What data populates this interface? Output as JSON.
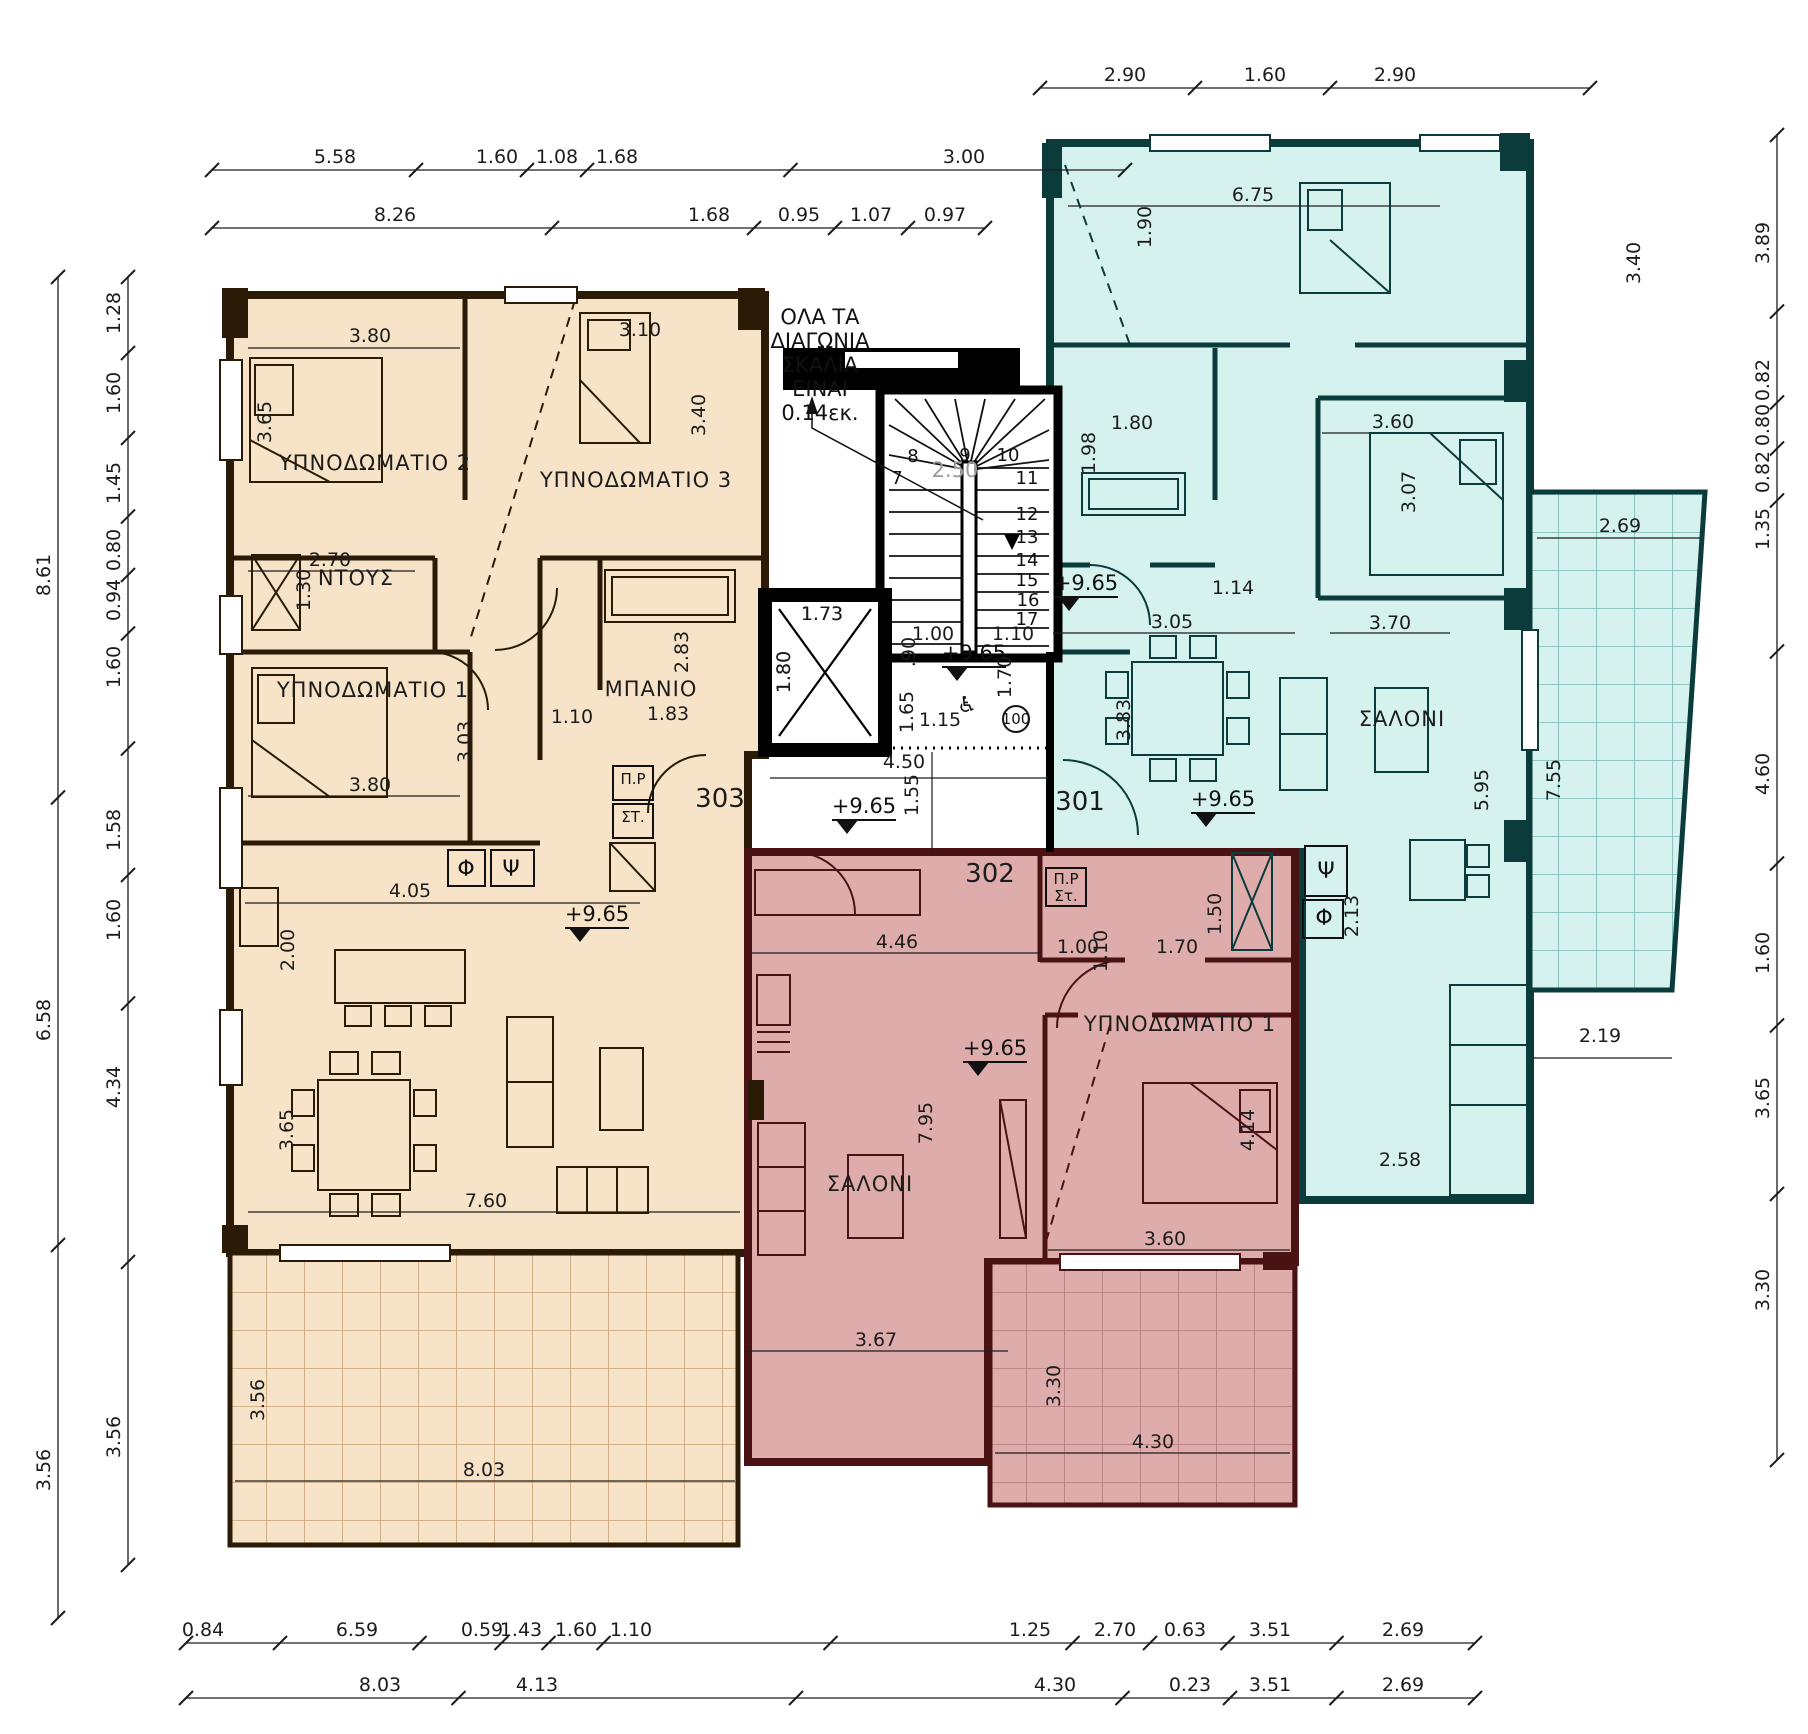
{
  "drawing": {
    "type": "architectural-floor-plan",
    "level_value": "+9.65",
    "units": [
      {
        "id": "301",
        "x": 1080,
        "y": 810,
        "fill": "#d6f2ef",
        "wall": "#0c3b3c"
      },
      {
        "id": "302",
        "x": 990,
        "y": 882,
        "fill": "#dfacac",
        "wall": "#4a1212"
      },
      {
        "id": "303",
        "x": 720,
        "y": 807,
        "fill": "#f6e3c8",
        "wall": "#2b1a06"
      }
    ]
  },
  "note": {
    "lines": [
      "ΟΛΑ ΤΑ",
      "ΔΙΑΓΩΝΙΑ",
      "ΣΚΑΛΙΑ",
      "ΕΙΝΑΙ",
      "0.14εκ."
    ],
    "x": 820,
    "y0": 324,
    "dy": 24
  },
  "stair": {
    "width_label": "2.50",
    "width_x": 955,
    "width_y": 477,
    "numbers": [
      [
        "7",
        897,
        484
      ],
      [
        "8",
        913,
        462
      ],
      [
        "9",
        965,
        461
      ],
      [
        "10",
        1008,
        461
      ],
      [
        "11",
        1027,
        484
      ],
      [
        "12",
        1027,
        520
      ],
      [
        "13",
        1027,
        543
      ],
      [
        "14",
        1027,
        566
      ],
      [
        "15",
        1027,
        586
      ],
      [
        "16",
        1028,
        606
      ],
      [
        "17",
        1027,
        625
      ]
    ]
  },
  "elevator": {
    "width": "1.80",
    "depth": "1.73"
  },
  "levels": [
    {
      "x": 974,
      "y": 660
    },
    {
      "x": 864,
      "y": 813
    },
    {
      "x": 1086,
      "y": 590
    },
    {
      "x": 1223,
      "y": 806
    },
    {
      "x": 597,
      "y": 921
    },
    {
      "x": 995,
      "y": 1055
    }
  ],
  "room_labels": [
    {
      "t": "ΥΠΝΟΔΩΜΑΤΙΟ 2",
      "x": 375,
      "y": 470
    },
    {
      "t": "ΥΠΝΟΔΩΜΑΤΙΟ 3",
      "x": 636,
      "y": 487
    },
    {
      "t": "ΝΤΟΥΣ",
      "x": 356,
      "y": 585
    },
    {
      "t": "ΥΠΝΟΔΩΜΑΤΙΟ 1",
      "x": 373,
      "y": 697
    },
    {
      "t": "ΜΠΑΝΙΟ",
      "x": 651,
      "y": 696
    },
    {
      "t": "ΣΑΛΟΝΙ",
      "x": 1402,
      "y": 726
    },
    {
      "t": "ΣΑΛΟΝΙ",
      "x": 870,
      "y": 1191
    },
    {
      "t": "ΥΠΝΟΔΩΜΑΤΙΟ 1",
      "x": 1180,
      "y": 1031
    }
  ],
  "symbols": [
    {
      "t": "Φ",
      "x": 466,
      "y": 876,
      "bx": 448,
      "by": 850,
      "bw": 37,
      "bh": 36,
      "big": true
    },
    {
      "t": "Ψ",
      "x": 511,
      "y": 876,
      "bx": 491,
      "by": 850,
      "bw": 43,
      "bh": 36,
      "big": true
    },
    {
      "t": "Π.Ρ",
      "x": 633,
      "y": 784,
      "bx": 613,
      "by": 766,
      "bw": 40,
      "bh": 34,
      "big": false
    },
    {
      "t": "ΣΤ.",
      "x": 633,
      "y": 822,
      "bx": 613,
      "by": 804,
      "bw": 40,
      "bh": 34,
      "big": false
    },
    {
      "t": "Π.Ρ",
      "x": 1066,
      "y": 884,
      "bx": 1046,
      "by": 868,
      "bw": 40,
      "bh": 38,
      "big": false
    },
    {
      "t": "Στ.",
      "x": 1066,
      "y": 901,
      "bx": 0,
      "by": 0,
      "bw": 0,
      "bh": 0,
      "big": false
    },
    {
      "t": "Ψ",
      "x": 1326,
      "y": 878,
      "bx": 1305,
      "by": 846,
      "bw": 42,
      "bh": 50,
      "big": true
    },
    {
      "t": "Φ",
      "x": 1324,
      "y": 925,
      "bx": 1303,
      "by": 900,
      "bw": 40,
      "bh": 38,
      "big": true
    }
  ],
  "access_circle": {
    "t": "100",
    "x": 1016,
    "y": 719,
    "r": 13
  },
  "whe": {
    "t": "♿",
    "x": 967,
    "y": 712
  },
  "free_dims": [
    {
      "v": "3.80",
      "x": 370,
      "y": 342,
      "r": 0
    },
    {
      "v": "3.65",
      "x": 271,
      "y": 422,
      "r": 1
    },
    {
      "v": "3.10",
      "x": 640,
      "y": 336,
      "r": 0
    },
    {
      "v": "3.40",
      "x": 705,
      "y": 415,
      "r": 1
    },
    {
      "v": "2.70",
      "x": 330,
      "y": 566,
      "r": 0
    },
    {
      "v": "1.30",
      "x": 310,
      "y": 590,
      "r": 1
    },
    {
      "v": "3.03",
      "x": 471,
      "y": 742,
      "r": 1
    },
    {
      "v": "3.80",
      "x": 370,
      "y": 791,
      "r": 0
    },
    {
      "v": "1.10",
      "x": 572,
      "y": 723,
      "r": 0
    },
    {
      "v": "2.83",
      "x": 688,
      "y": 652,
      "r": 1
    },
    {
      "v": "1.83",
      "x": 668,
      "y": 720,
      "r": 0
    },
    {
      "v": "4.05",
      "x": 410,
      "y": 897,
      "r": 0
    },
    {
      "v": "2.00",
      "x": 294,
      "y": 950,
      "r": 1
    },
    {
      "v": "3.65",
      "x": 293,
      "y": 1130,
      "r": 1
    },
    {
      "v": "7.60",
      "x": 486,
      "y": 1207,
      "r": 0
    },
    {
      "v": "8.03",
      "x": 484,
      "y": 1476,
      "r": 0
    },
    {
      "v": "3.56",
      "x": 264,
      "y": 1400,
      "r": 1
    },
    {
      "v": "1.80",
      "x": 790,
      "y": 672,
      "r": 1
    },
    {
      "v": "1.73",
      "x": 822,
      "y": 620,
      "r": 0
    },
    {
      "v": "1.00",
      "x": 933,
      "y": 640,
      "r": 0
    },
    {
      "v": "1.10",
      "x": 1013,
      "y": 640,
      "r": 0
    },
    {
      "v": ".90",
      "x": 915,
      "y": 652,
      "r": 1
    },
    {
      "v": "1.65",
      "x": 913,
      "y": 712,
      "r": 1
    },
    {
      "v": "1.15",
      "x": 940,
      "y": 726,
      "r": 0
    },
    {
      "v": "1.70",
      "x": 1011,
      "y": 677,
      "r": 1
    },
    {
      "v": "4.50",
      "x": 904,
      "y": 768,
      "r": 0
    },
    {
      "v": "1.55",
      "x": 918,
      "y": 795,
      "r": 1
    },
    {
      "v": "6.75",
      "x": 1253,
      "y": 201,
      "r": 0
    },
    {
      "v": "1.90",
      "x": 1151,
      "y": 227,
      "r": 1
    },
    {
      "v": "3.40",
      "x": 1640,
      "y": 263,
      "r": 1
    },
    {
      "v": "1.80",
      "x": 1132,
      "y": 429,
      "r": 0
    },
    {
      "v": "1.98",
      "x": 1095,
      "y": 453,
      "r": 1
    },
    {
      "v": "3.60",
      "x": 1393,
      "y": 428,
      "r": 0
    },
    {
      "v": "3.07",
      "x": 1415,
      "y": 492,
      "r": 1
    },
    {
      "v": "1.14",
      "x": 1233,
      "y": 594,
      "r": 0
    },
    {
      "v": "3.05",
      "x": 1172,
      "y": 628,
      "r": 0
    },
    {
      "v": "3.70",
      "x": 1390,
      "y": 629,
      "r": 0
    },
    {
      "v": "3.83",
      "x": 1130,
      "y": 720,
      "r": 1
    },
    {
      "v": "5.95",
      "x": 1488,
      "y": 790,
      "r": 1
    },
    {
      "v": "2.13",
      "x": 1358,
      "y": 916,
      "r": 1
    },
    {
      "v": "2.58",
      "x": 1400,
      "y": 1166,
      "r": 0
    },
    {
      "v": "2.69",
      "x": 1620,
      "y": 532,
      "r": 0
    },
    {
      "v": "7.55",
      "x": 1560,
      "y": 780,
      "r": 1
    },
    {
      "v": "2.19",
      "x": 1600,
      "y": 1042,
      "r": 0
    },
    {
      "v": "1.00",
      "x": 1078,
      "y": 953,
      "r": 0
    },
    {
      "v": "1.10",
      "x": 1107,
      "y": 951,
      "r": 1
    },
    {
      "v": "1.70",
      "x": 1177,
      "y": 953,
      "r": 0
    },
    {
      "v": "1.50",
      "x": 1221,
      "y": 914,
      "r": 1
    },
    {
      "v": "4.46",
      "x": 897,
      "y": 948,
      "r": 0
    },
    {
      "v": "7.95",
      "x": 932,
      "y": 1123,
      "r": 1
    },
    {
      "v": "4.14",
      "x": 1254,
      "y": 1130,
      "r": 1
    },
    {
      "v": "3.60",
      "x": 1165,
      "y": 1245,
      "r": 0
    },
    {
      "v": "3.67",
      "x": 876,
      "y": 1346,
      "r": 0
    },
    {
      "v": "3.30",
      "x": 1060,
      "y": 1386,
      "r": 1
    },
    {
      "v": "4.30",
      "x": 1153,
      "y": 1448,
      "r": 0
    }
  ],
  "chains": [
    {
      "dir": "h",
      "y": 88,
      "a": 1040,
      "b": 1590,
      "labels": [
        [
          "2.90",
          1125
        ],
        [
          "1.60",
          1265
        ],
        [
          "2.90",
          1395
        ]
      ]
    },
    {
      "dir": "h",
      "y": 170,
      "a": 212,
      "b": 1125,
      "labels": [
        [
          "5.58",
          335
        ],
        [
          "1.60",
          497
        ],
        [
          "1.08",
          557
        ],
        [
          "1.68",
          617
        ],
        [
          "3.00",
          964
        ]
      ]
    },
    {
      "dir": "h",
      "y": 228,
      "a": 212,
      "b": 985,
      "labels": [
        [
          "8.26",
          395
        ],
        [
          "1.68",
          709
        ],
        [
          "0.95",
          799
        ],
        [
          "1.07",
          871
        ],
        [
          "0.97",
          945
        ]
      ]
    },
    {
      "dir": "v",
      "x": 58,
      "a": 277,
      "b": 1618,
      "labels": [
        [
          "8.61",
          575
        ],
        [
          "6.58",
          1020
        ],
        [
          "3.56",
          1470
        ]
      ]
    },
    {
      "dir": "v",
      "x": 128,
      "a": 277,
      "b": 1565,
      "labels": [
        [
          "1.28",
          313
        ],
        [
          "1.60",
          393
        ],
        [
          "1.45",
          483
        ],
        [
          "0.80",
          550
        ],
        [
          "0.94",
          600
        ],
        [
          "1.60",
          667
        ],
        [
          "1.58",
          830
        ],
        [
          "1.60",
          920
        ],
        [
          "4.34",
          1087
        ],
        [
          "3.56",
          1437
        ]
      ]
    },
    {
      "dir": "v",
      "x": 1777,
      "a": 135,
      "b": 1460,
      "labels": [
        [
          "3.89",
          243
        ],
        [
          "0.82",
          380
        ],
        [
          "0.80",
          425
        ],
        [
          "0.82",
          472
        ],
        [
          "1.35",
          529
        ],
        [
          "4.60",
          774
        ],
        [
          "1.60",
          953
        ],
        [
          "3.65",
          1098
        ],
        [
          "3.30",
          1290
        ]
      ]
    },
    {
      "dir": "h",
      "y": 1643,
      "a": 186,
      "b": 1475,
      "labels": [
        [
          "0.84",
          203
        ],
        [
          "6.59",
          357
        ],
        [
          "0.59",
          482
        ],
        [
          "1.43",
          521
        ],
        [
          "1.60",
          576
        ],
        [
          "1.10",
          631
        ],
        [
          "1.25",
          1030
        ],
        [
          "2.70",
          1115
        ],
        [
          "0.63",
          1185
        ],
        [
          "3.51",
          1270
        ],
        [
          "2.69",
          1403
        ]
      ]
    },
    {
      "dir": "h",
      "y": 1698,
      "a": 186,
      "b": 1475,
      "labels": [
        [
          "8.03",
          380
        ],
        [
          "4.13",
          537
        ],
        [
          "4.30",
          1055
        ],
        [
          "0.23",
          1190
        ],
        [
          "3.51",
          1270
        ],
        [
          "2.69",
          1403
        ]
      ]
    }
  ]
}
